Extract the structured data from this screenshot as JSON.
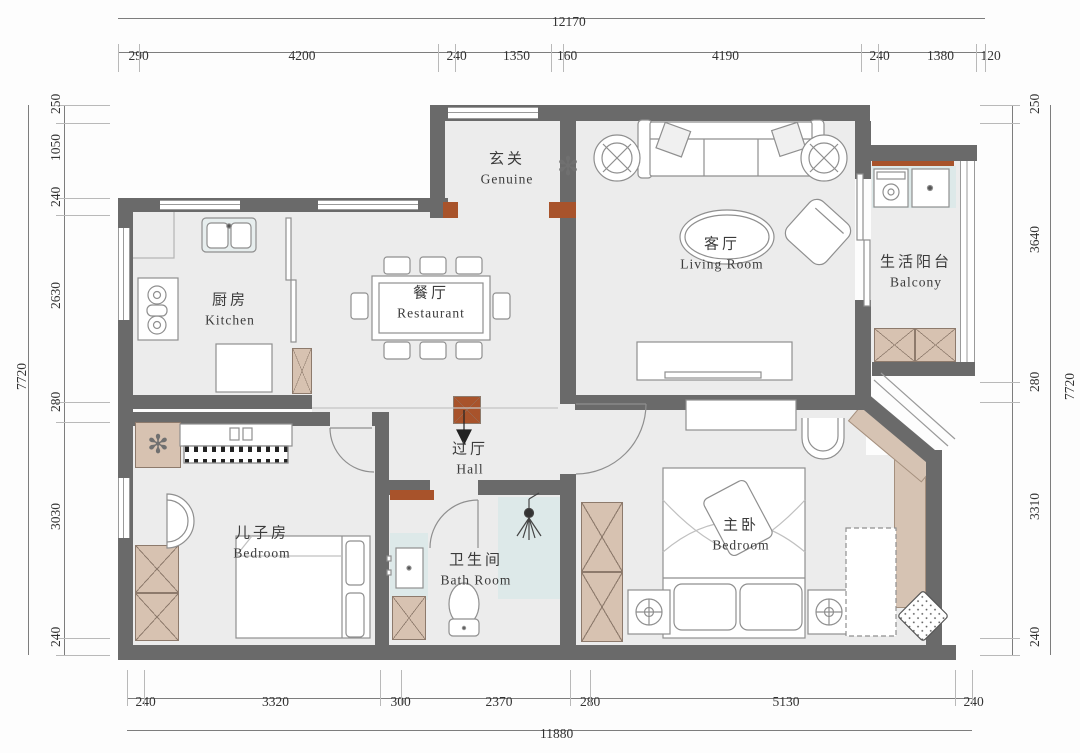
{
  "title": "apartment-floor-plan",
  "colors": {
    "wall": "#6a6a6a",
    "accent_wall": "#a8532b",
    "floor": "#ececec",
    "cabinet": "#d7c2b1",
    "wet_area": "#dde9e9",
    "window_seat": "#d6c3b3",
    "furniture_line": "#8f8f8f",
    "dimension_text": "#333333"
  },
  "dimensions": {
    "top": {
      "total": "12170",
      "segments": [
        "290",
        "4200",
        "240",
        "1350",
        "160",
        "4190",
        "240",
        "1380",
        "120"
      ]
    },
    "bottom": {
      "total": "11880",
      "segments": [
        "240",
        "3320",
        "300",
        "2370",
        "280",
        "5130",
        "240"
      ]
    },
    "left": {
      "total": "7720",
      "segments": [
        "250",
        "1050",
        "240",
        "2630",
        "280",
        "3030",
        "240"
      ]
    },
    "right": {
      "total": "7720",
      "segments": [
        "250",
        "3640",
        "280",
        "3310",
        "240"
      ]
    }
  },
  "rooms": {
    "entry": {
      "zh": "玄关",
      "en": "Genuine"
    },
    "living": {
      "zh": "客厅",
      "en": "Living Room"
    },
    "balcony": {
      "zh": "生活阳台",
      "en": "Balcony"
    },
    "kitchen": {
      "zh": "厨房",
      "en": "Kitchen"
    },
    "dining": {
      "zh": "餐厅",
      "en": "Restaurant"
    },
    "hall": {
      "zh": "过厅",
      "en": "Hall"
    },
    "kids_room": {
      "zh": "儿子房",
      "en": "Bedroom"
    },
    "bathroom": {
      "zh": "卫生间",
      "en": "Bath Room"
    },
    "master": {
      "zh": "主卧",
      "en": "Bedroom"
    }
  },
  "decor": {
    "flower_glyph": "✻"
  }
}
